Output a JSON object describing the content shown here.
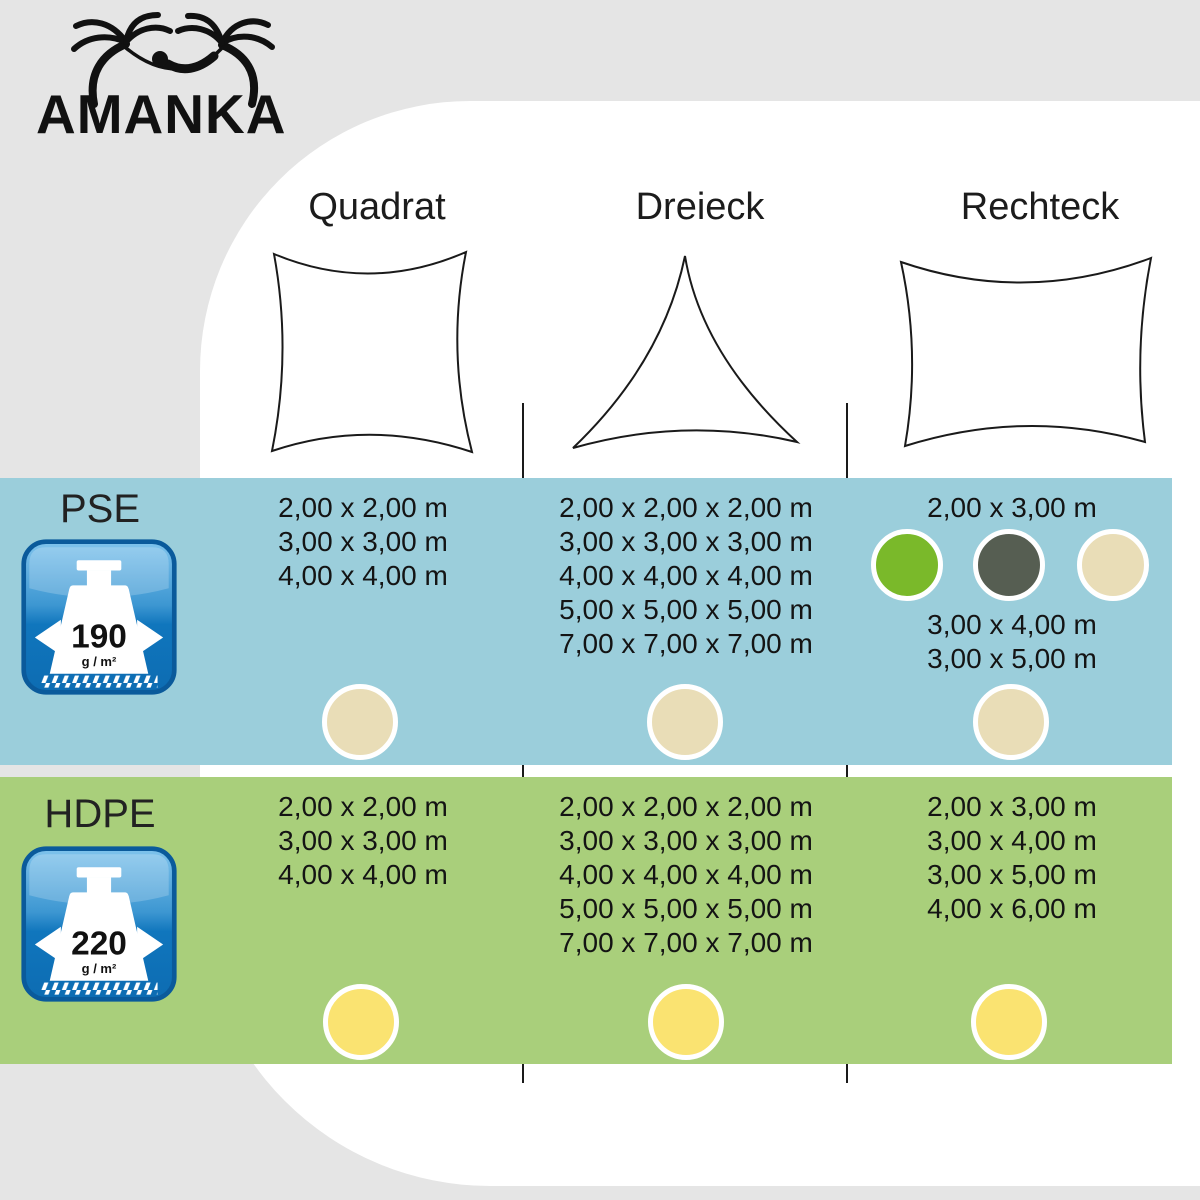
{
  "brand": {
    "name": "AMANKA"
  },
  "page": {
    "background": "#e5e5e5",
    "panel_background": "#ffffff",
    "text_color": "#1a1a1a"
  },
  "table": {
    "columns": [
      {
        "label": "Quadrat",
        "shape": "square-sail"
      },
      {
        "label": "Dreieck",
        "shape": "triangle-sail"
      },
      {
        "label": "Rechteck",
        "shape": "rectangle-sail"
      }
    ],
    "rows": [
      {
        "material": "PSE",
        "weight_value": "190",
        "weight_unit": "g / m²",
        "row_bg": "#9bcedb",
        "dot_color": "#e9ddb7",
        "quadrat_sizes": [
          "2,00 x 2,00 m",
          "3,00 x 3,00 m",
          "4,00 x 4,00 m"
        ],
        "dreieck_sizes": [
          "2,00 x 2,00 x 2,00 m",
          "3,00 x 3,00 x 3,00 m",
          "4,00 x 4,00 x 4,00 m",
          "5,00 x 5,00 x 5,00 m",
          "7,00 x 7,00 x 7,00 m"
        ],
        "rechteck_size_top": "2,00 x 3,00 m",
        "rechteck_swatches": [
          "#7ab92a",
          "#565e52",
          "#e9ddb7"
        ],
        "rechteck_sizes_bottom": [
          "3,00 x 4,00 m",
          "3,00 x 5,00 m"
        ]
      },
      {
        "material": "HDPE",
        "weight_value": "220",
        "weight_unit": "g / m²",
        "row_bg": "#a9cf7b",
        "dot_color": "#fae371",
        "quadrat_sizes": [
          "2,00 x 2,00 m",
          "3,00 x 3,00 m",
          "4,00 x 4,00 m"
        ],
        "dreieck_sizes": [
          "2,00 x 2,00 x 2,00 m",
          "3,00 x 3,00 x 3,00 m",
          "4,00 x 4,00 x 4,00 m",
          "5,00 x 5,00 x 5,00 m",
          "7,00 x 7,00 x 7,00 m"
        ],
        "rechteck_sizes": [
          "2,00 x 3,00 m",
          "3,00 x 4,00 m",
          "3,00 x 5,00 m",
          "4,00 x 6,00 m"
        ]
      }
    ]
  }
}
